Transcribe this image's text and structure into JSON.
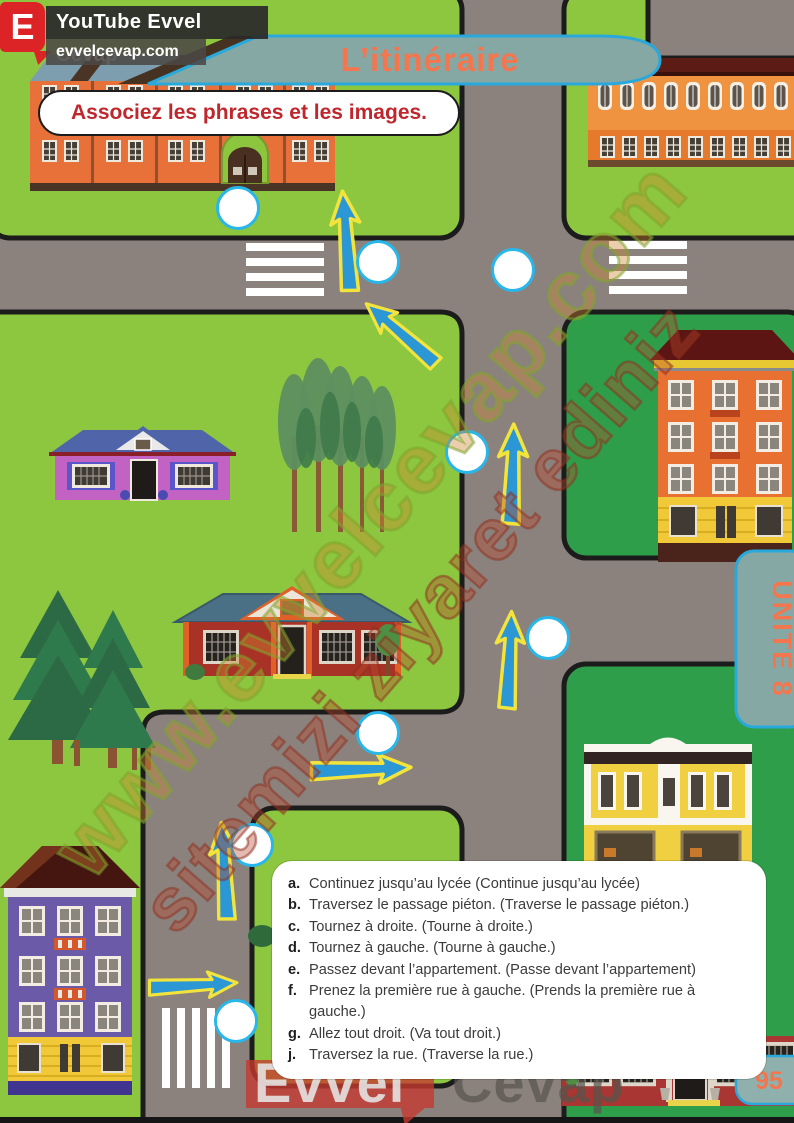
{
  "branding": {
    "logo_letter": "E",
    "channel_name": "YouTube Evvel Cevap",
    "website": "evvelcevap.com",
    "diagonal_watermark_main": "www.evvelcevap.com",
    "diagonal_watermark_sub": "sitemizi ziyaret ediniz",
    "footer_watermark_word1": "Evvel",
    "footer_watermark_word2": "Cevap"
  },
  "lesson": {
    "title": "L’itinéraire",
    "unit_tab": "UNITÉ 8",
    "instruction": "Associez les phrases et les images.",
    "phrases": [
      {
        "letter": "a.",
        "text": "Continuez jusqu’au lycée (Continue jusqu’au lycée)"
      },
      {
        "letter": "b.",
        "text": "Traversez le passage piéton. (Traverse le passage piéton.)"
      },
      {
        "letter": "c.",
        "text": "Tournez à droite. (Tourne à droite.)"
      },
      {
        "letter": "d.",
        "text": "Tournez à gauche. (Tourne à gauche.)"
      },
      {
        "letter": "e.",
        "text": "Passez devant l’appartement. (Passe devant l’appartement)"
      },
      {
        "letter": "f.",
        "text": "Prenez la première rue à gauche. (Prends la première rue à gauche.)"
      },
      {
        "letter": "g.",
        "text": "Allez tout droit. (Va tout droit.)"
      },
      {
        "letter": "j.",
        "text": "Traversez la rue. (Traverse la rue.)"
      }
    ]
  },
  "page": {
    "number": "95"
  },
  "map": {
    "answer_circle_count": 8,
    "arrow_count": 7
  },
  "colors": {
    "grass_light": "#8dc63f",
    "grass_dark": "#2f9e4a",
    "road_gray": "#8b827d",
    "banner_teal": "#85a8a4",
    "accent_cyan": "#29a9db",
    "title_orange": "#f4764f",
    "instruction_red": "#c0272d",
    "arrow_blue": "#2b97d4",
    "arrow_yellow": "#f2e43c",
    "circle_border": "#29b6e8"
  }
}
